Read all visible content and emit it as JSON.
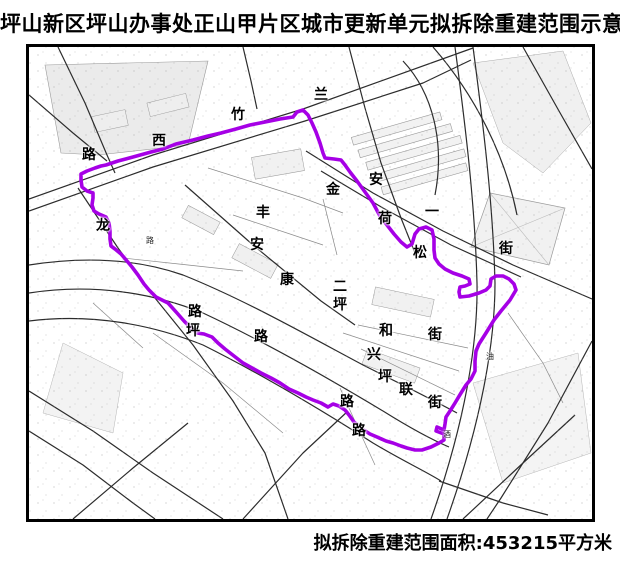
{
  "title": "坪山新区坪山办事处正山甲片区城市更新单元拟拆除重建范围示意图",
  "footer": {
    "area_label": "拟拆除重建范围面积:453215平方米"
  },
  "map": {
    "boundary_color": "#A600E6",
    "frame_color": "#000000",
    "boundary_stroke_width": 3.6,
    "street_labels": [
      {
        "text": "竹",
        "x": 235,
        "y": 112
      },
      {
        "text": "西",
        "x": 156,
        "y": 138
      },
      {
        "text": "路",
        "x": 86,
        "y": 152
      },
      {
        "text": "兰",
        "x": 318,
        "y": 92
      },
      {
        "text": "龙",
        "x": 100,
        "y": 223
      },
      {
        "text": "丰",
        "x": 260,
        "y": 210
      },
      {
        "text": "金",
        "x": 330,
        "y": 187
      },
      {
        "text": "安",
        "x": 373,
        "y": 177
      },
      {
        "text": "荷",
        "x": 382,
        "y": 216
      },
      {
        "text": "一",
        "x": 429,
        "y": 209
      },
      {
        "text": "安",
        "x": 254,
        "y": 242
      },
      {
        "text": "康",
        "x": 284,
        "y": 277
      },
      {
        "text": "松",
        "x": 417,
        "y": 250
      },
      {
        "text": "街",
        "x": 503,
        "y": 246
      },
      {
        "text": "二",
        "x": 337,
        "y": 284
      },
      {
        "text": "坪",
        "x": 337,
        "y": 302
      },
      {
        "text": "路",
        "x": 192,
        "y": 309
      },
      {
        "text": "坪",
        "x": 190,
        "y": 328
      },
      {
        "text": "路",
        "x": 258,
        "y": 334
      },
      {
        "text": "和",
        "x": 383,
        "y": 328
      },
      {
        "text": "街",
        "x": 432,
        "y": 332
      },
      {
        "text": "兴",
        "x": 371,
        "y": 352
      },
      {
        "text": "坪",
        "x": 382,
        "y": 374
      },
      {
        "text": "联",
        "x": 403,
        "y": 387
      },
      {
        "text": "街",
        "x": 432,
        "y": 400
      },
      {
        "text": "路",
        "x": 344,
        "y": 399
      },
      {
        "text": "路",
        "x": 356,
        "y": 428
      }
    ],
    "small_labels": [
      {
        "text": "路",
        "x": 147,
        "y": 238
      },
      {
        "text": "油",
        "x": 487,
        "y": 354
      },
      {
        "text": "酒",
        "x": 444,
        "y": 432
      }
    ],
    "boundary_points": [
      [
        103,
        162
      ],
      [
        115,
        158
      ],
      [
        130,
        154
      ],
      [
        148,
        149
      ],
      [
        160,
        146
      ],
      [
        173,
        141
      ],
      [
        190,
        137
      ],
      [
        205,
        133
      ],
      [
        218,
        130
      ],
      [
        233,
        126
      ],
      [
        247,
        122
      ],
      [
        262,
        119
      ],
      [
        277,
        116
      ],
      [
        290,
        114
      ],
      [
        294,
        109
      ],
      [
        300,
        107
      ],
      [
        305,
        112
      ],
      [
        309,
        120
      ],
      [
        313,
        129
      ],
      [
        317,
        140
      ],
      [
        320,
        150
      ],
      [
        322,
        155
      ],
      [
        331,
        156
      ],
      [
        338,
        157
      ],
      [
        342,
        162
      ],
      [
        347,
        169
      ],
      [
        354,
        178
      ],
      [
        362,
        189
      ],
      [
        370,
        200
      ],
      [
        377,
        213
      ],
      [
        384,
        222
      ],
      [
        391,
        231
      ],
      [
        398,
        239
      ],
      [
        404,
        244
      ],
      [
        409,
        241
      ],
      [
        412,
        231
      ],
      [
        416,
        226
      ],
      [
        423,
        224
      ],
      [
        429,
        227
      ],
      [
        431,
        236
      ],
      [
        431,
        247
      ],
      [
        432,
        255
      ],
      [
        436,
        261
      ],
      [
        442,
        266
      ],
      [
        450,
        270
      ],
      [
        459,
        273
      ],
      [
        466,
        276
      ],
      [
        467,
        281
      ],
      [
        462,
        283
      ],
      [
        457,
        284
      ],
      [
        456,
        289
      ],
      [
        457,
        294
      ],
      [
        466,
        293
      ],
      [
        476,
        290
      ],
      [
        483,
        287
      ],
      [
        487,
        283
      ],
      [
        488,
        276
      ],
      [
        493,
        273
      ],
      [
        500,
        273
      ],
      [
        506,
        276
      ],
      [
        511,
        281
      ],
      [
        513,
        287
      ],
      [
        507,
        297
      ],
      [
        498,
        308
      ],
      [
        491,
        317
      ],
      [
        483,
        330
      ],
      [
        476,
        341
      ],
      [
        473,
        348
      ],
      [
        472,
        358
      ],
      [
        472,
        368
      ],
      [
        468,
        376
      ],
      [
        463,
        382
      ],
      [
        458,
        390
      ],
      [
        452,
        400
      ],
      [
        447,
        408
      ],
      [
        443,
        414
      ],
      [
        442,
        421
      ],
      [
        441,
        427
      ],
      [
        434,
        424
      ],
      [
        433,
        428
      ],
      [
        441,
        431
      ],
      [
        441,
        437
      ],
      [
        436,
        440
      ],
      [
        428,
        444
      ],
      [
        419,
        447
      ],
      [
        412,
        447
      ],
      [
        404,
        445
      ],
      [
        398,
        443
      ],
      [
        390,
        440
      ],
      [
        383,
        438
      ],
      [
        374,
        434
      ],
      [
        367,
        431
      ],
      [
        359,
        426
      ],
      [
        351,
        419
      ],
      [
        346,
        412
      ],
      [
        342,
        407
      ],
      [
        336,
        403
      ],
      [
        330,
        401
      ],
      [
        325,
        404
      ],
      [
        318,
        400
      ],
      [
        310,
        397
      ],
      [
        303,
        394
      ],
      [
        295,
        390
      ],
      [
        286,
        386
      ],
      [
        277,
        380
      ],
      [
        268,
        375
      ],
      [
        258,
        370
      ],
      [
        249,
        365
      ],
      [
        240,
        360
      ],
      [
        231,
        353
      ],
      [
        222,
        346
      ],
      [
        215,
        340
      ],
      [
        209,
        334
      ],
      [
        201,
        331
      ],
      [
        194,
        330
      ],
      [
        188,
        325
      ],
      [
        181,
        318
      ],
      [
        174,
        310
      ],
      [
        165,
        300
      ],
      [
        153,
        294
      ],
      [
        146,
        287
      ],
      [
        141,
        281
      ],
      [
        135,
        272
      ],
      [
        129,
        264
      ],
      [
        124,
        258
      ],
      [
        118,
        251
      ],
      [
        112,
        246
      ],
      [
        108,
        243
      ],
      [
        107,
        236
      ],
      [
        107,
        228
      ],
      [
        106,
        220
      ],
      [
        103,
        214
      ],
      [
        96,
        211
      ],
      [
        91,
        208
      ],
      [
        89,
        202
      ],
      [
        90,
        195
      ],
      [
        90,
        190
      ],
      [
        84,
        188
      ],
      [
        79,
        184
      ],
      [
        78,
        177
      ],
      [
        78,
        171
      ],
      [
        84,
        168
      ],
      [
        92,
        165
      ],
      [
        98,
        163
      ]
    ]
  }
}
